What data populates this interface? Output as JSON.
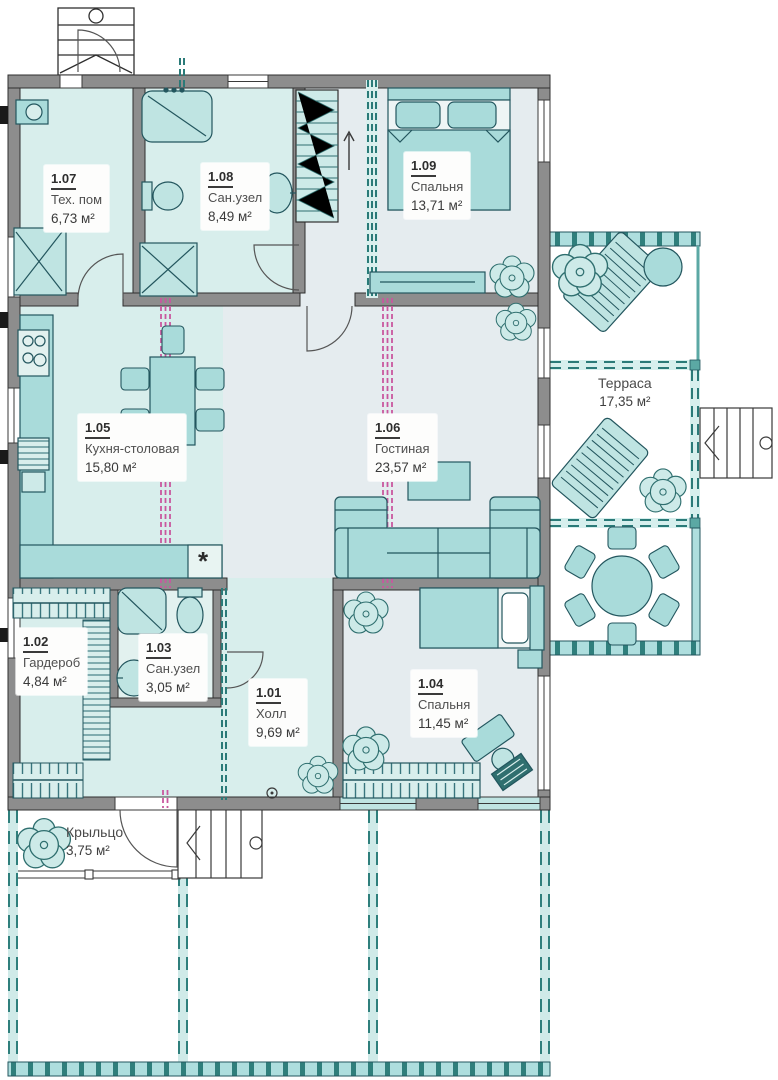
{
  "rooms": [
    {
      "id": "1.07",
      "name": "Тех. пом",
      "area": "6,73 м²"
    },
    {
      "id": "1.08",
      "name": "Сан.узел",
      "area": "8,49 м²"
    },
    {
      "id": "1.09",
      "name": "Спальня",
      "area": "13,71 м²"
    },
    {
      "id": "1.05",
      "name": "Кухня-столовая",
      "area": "15,80 м²"
    },
    {
      "id": "1.06",
      "name": "Гостиная",
      "area": "23,57 м²"
    },
    {
      "id": "1.02",
      "name": "Гардероб",
      "area": "4,84 м²"
    },
    {
      "id": "1.03",
      "name": "Сан.узел",
      "area": "3,05 м²"
    },
    {
      "id": "1.01",
      "name": "Холл",
      "area": "9,69 м²"
    },
    {
      "id": "1.04",
      "name": "Спальня",
      "area": "11,45 м²"
    }
  ],
  "outdoor": {
    "terrace": {
      "name": "Терраса",
      "area": "17,35 м²"
    },
    "porch": {
      "name": "Крыльцо",
      "area": "3,75 м²"
    }
  },
  "kitchen": {
    "appliance_symbol": "*"
  },
  "colors": {
    "wall": "#8d8d8d",
    "wall_edge": "#2f2f2f",
    "room_mint": "#d8eeec",
    "room_blue": "#e5ecef",
    "furniture": "#a9dbda",
    "furniture_edge": "#23565e",
    "deck_teal": "#aedede",
    "accent_teal": "#2a7a78",
    "partition_pink": "#c9579f"
  }
}
